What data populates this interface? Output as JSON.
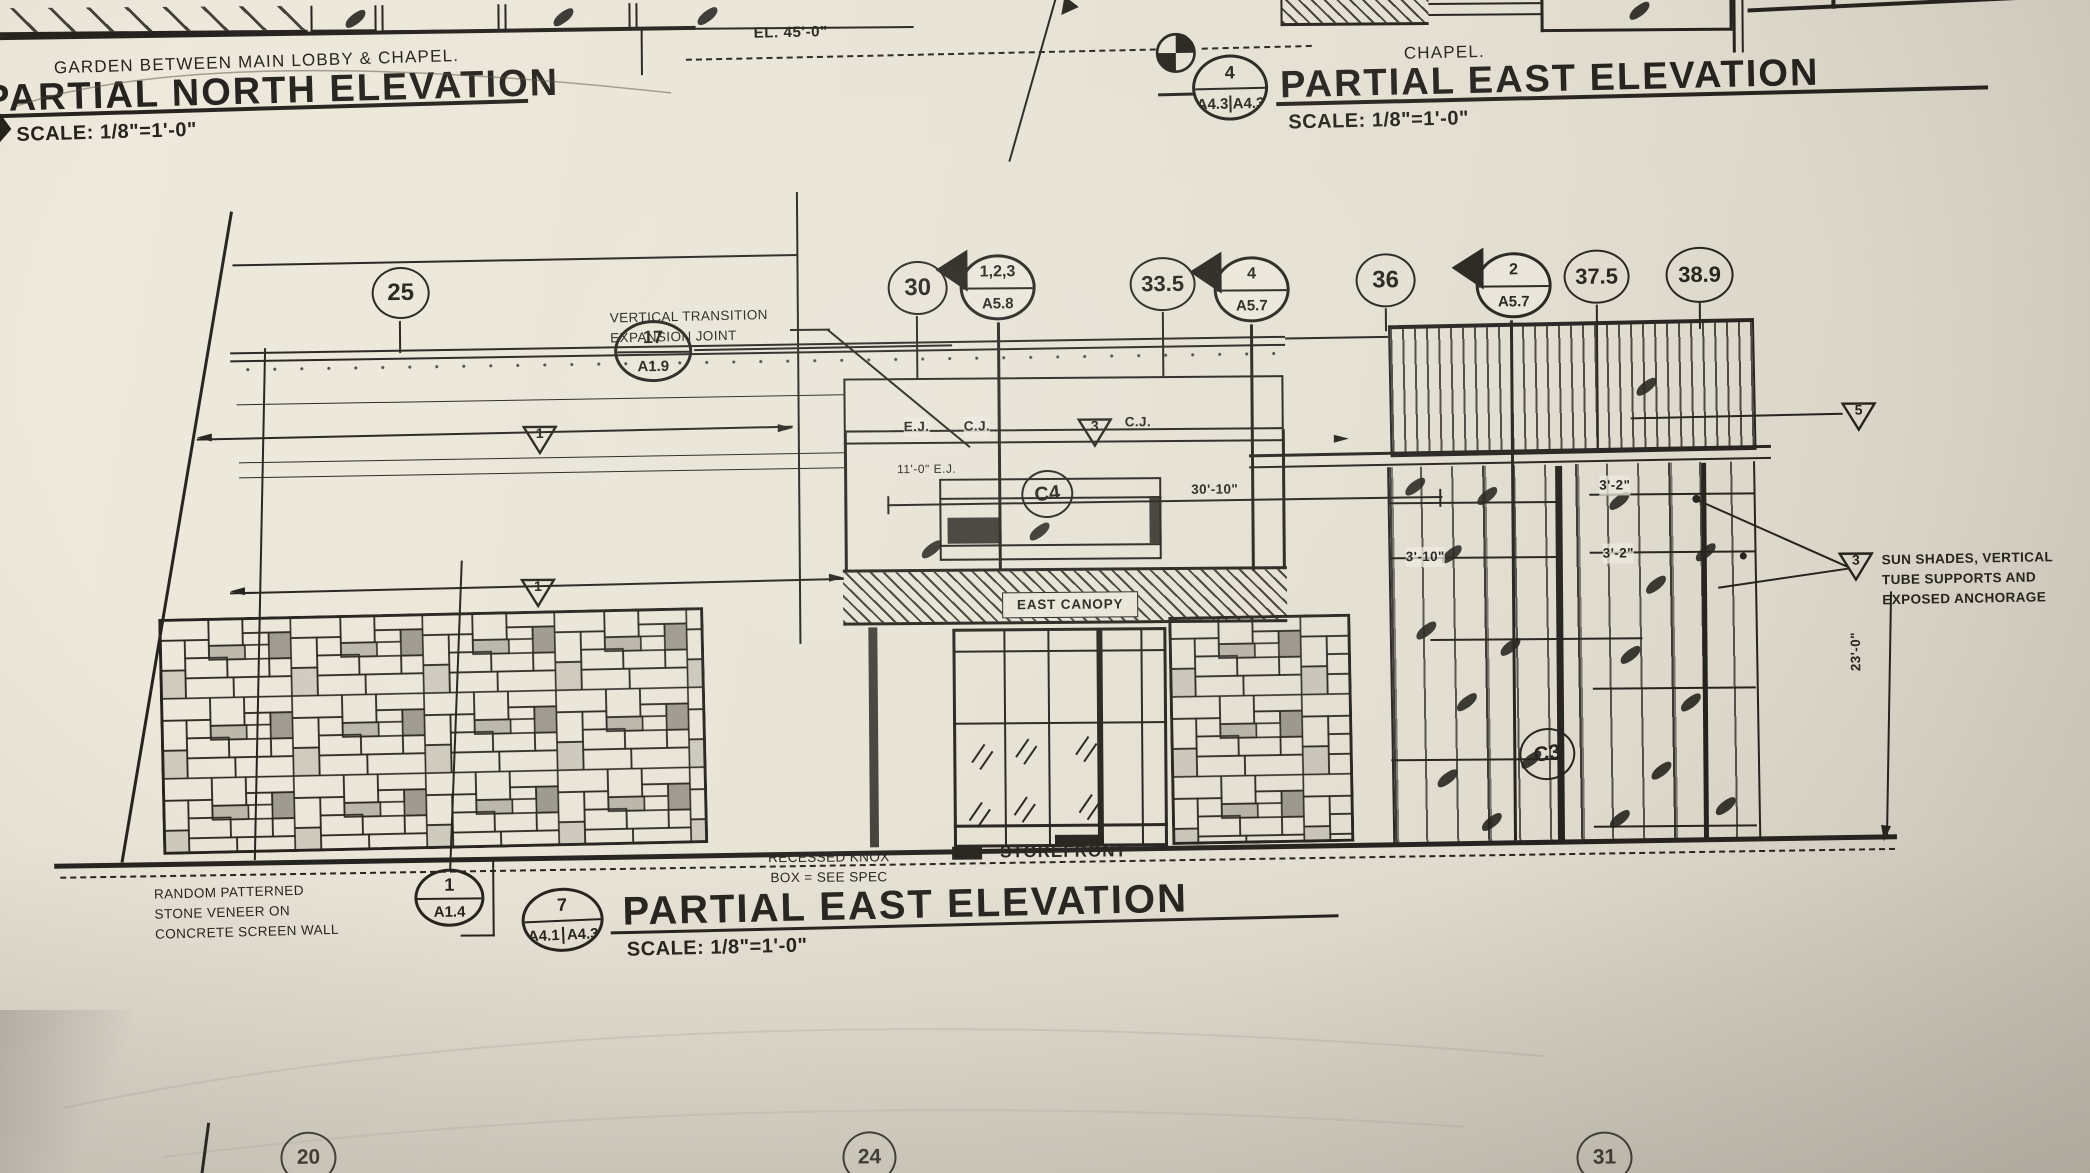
{
  "meta": {
    "paper_color": "#e9e4d7",
    "ink_color": "#26231e"
  },
  "north_elevation": {
    "note": "GARDEN BETWEEN MAIN LOBBY & CHAPEL.",
    "title": "PARTIAL NORTH ELEVATION",
    "scale": "SCALE: 1/8\"=1'-0\""
  },
  "east_elevation_top": {
    "note": "CHAPEL.",
    "title": "PARTIAL EAST ELEVATION",
    "scale": "SCALE: 1/8\"=1'-0\"",
    "ref_num": "4",
    "ref_sheet_left": "A4.3",
    "ref_sheet_right": "A4.3"
  },
  "east_elevation_bottom": {
    "title": "PARTIAL EAST ELEVATION",
    "scale": "SCALE: 1/8\"=1'-0\"",
    "ref_num": "7",
    "ref_sheet_left": "A4.1",
    "ref_sheet_right": "A4.3"
  },
  "grid_bubbles": {
    "b25": "25",
    "b30": "30",
    "b33_5": "33.5",
    "b36": "36",
    "b37_5": "37.5",
    "b38_9": "38.9",
    "b20": "20",
    "b24": "24",
    "b31": "31"
  },
  "section_markers": {
    "m123": {
      "num": "1,2,3",
      "sheet": "A5.8"
    },
    "m4": {
      "num": "4",
      "sheet": "A5.7"
    },
    "m2": {
      "num": "2",
      "sheet": "A5.7"
    }
  },
  "detail_bubbles": {
    "d17": {
      "num": "17",
      "sheet": "A1.9"
    },
    "d1": {
      "num": "1",
      "sheet": "A1.4"
    },
    "c4": "C4",
    "c3": "C3"
  },
  "keynotes": {
    "k1a": "1",
    "k1b": "1",
    "k3a": "3",
    "k3b": "3",
    "k5": "5"
  },
  "labels": {
    "vertical_transition_line1": "VERTICAL TRANSITION",
    "vertical_transition_line2": "EXPANSION JOINT",
    "ej": "E.J.",
    "cj": "C.J.",
    "cj2": "C.J.",
    "ej_dim": "11'-0\" E.J.",
    "east_canopy": "EAST CANOPY",
    "storefront": "STOREFRONT",
    "knox_line1": "RECESSED KNOX",
    "knox_line2": "BOX = SEE SPEC",
    "stone_line1": "RANDOM PATTERNED",
    "stone_line2": "STONE VENEER ON",
    "stone_line3": "CONCRETE SCREEN WALL",
    "sunshade_line1": "SUN SHADES, VERTICAL",
    "sunshade_line2": "TUBE SUPPORTS AND",
    "sunshade_line3": "EXPOSED ANCHORAGE"
  },
  "dimensions": {
    "el_top": "EL. 45'-0\"",
    "d30_10": "30'-10\"",
    "d3_2a": "3'-2\"",
    "d3_2b": "3'-2\"",
    "d3_10": "3'-10\"",
    "d23_0": "23'-0\""
  }
}
